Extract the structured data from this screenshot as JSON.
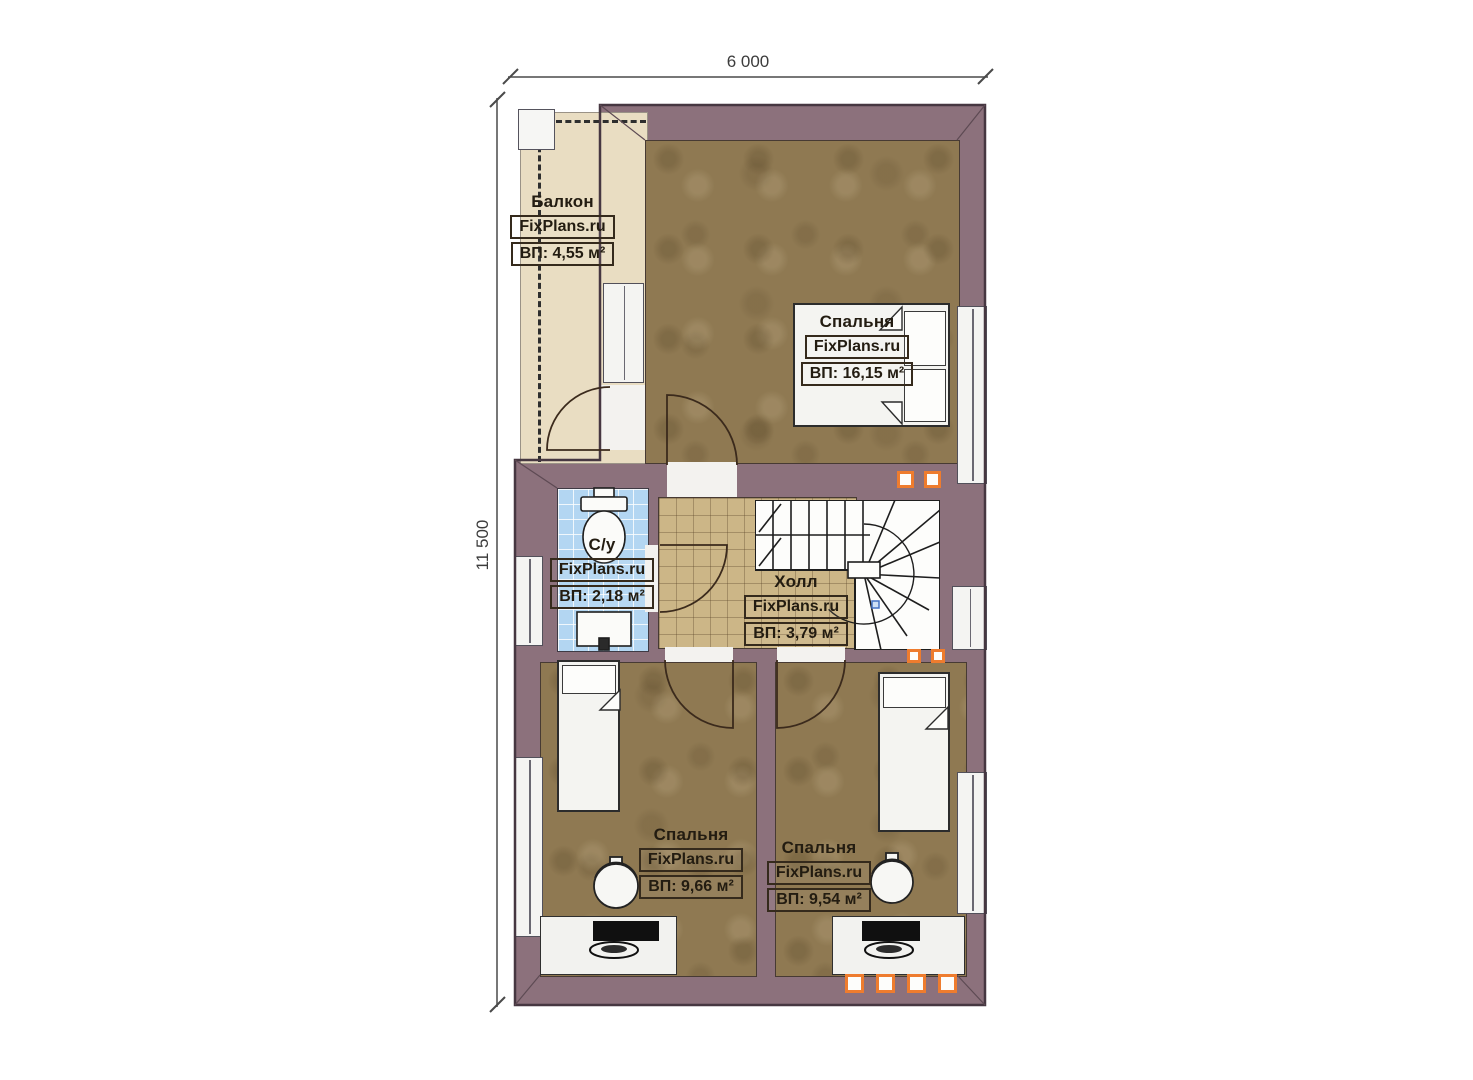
{
  "title": "Floor plan — second level",
  "dimensions": {
    "width_label": "6 000",
    "height_label": "11 500"
  },
  "rooms": [
    {
      "key": "balcony",
      "name": "Балкон",
      "brand": "FixPlans.ru",
      "area": "ВП: 4,55 м²"
    },
    {
      "key": "bedroom-master",
      "name": "Спальня",
      "brand": "FixPlans.ru",
      "area": "ВП: 16,15 м²"
    },
    {
      "key": "bathroom",
      "name": "С/у",
      "brand": "FixPlans.ru",
      "area": "ВП: 2,18 м²"
    },
    {
      "key": "hall",
      "name": "Холл",
      "brand": "FixPlans.ru",
      "area": "ВП: 3,79 м²"
    },
    {
      "key": "bedroom-left",
      "name": "Спальня",
      "brand": "FixPlans.ru",
      "area": "ВП: 9,66 м²"
    },
    {
      "key": "bedroom-right",
      "name": "Спальня",
      "brand": "FixPlans.ru",
      "area": "ВП: 9,54 м²"
    }
  ],
  "colors": {
    "wall": "#8c717c",
    "floor_wood": "#8f7952",
    "balcony": "#e9ddc2",
    "tile_bath": "#b3d6f2",
    "tile_hall": "#ccb687",
    "accent": "#ee7c2e"
  }
}
